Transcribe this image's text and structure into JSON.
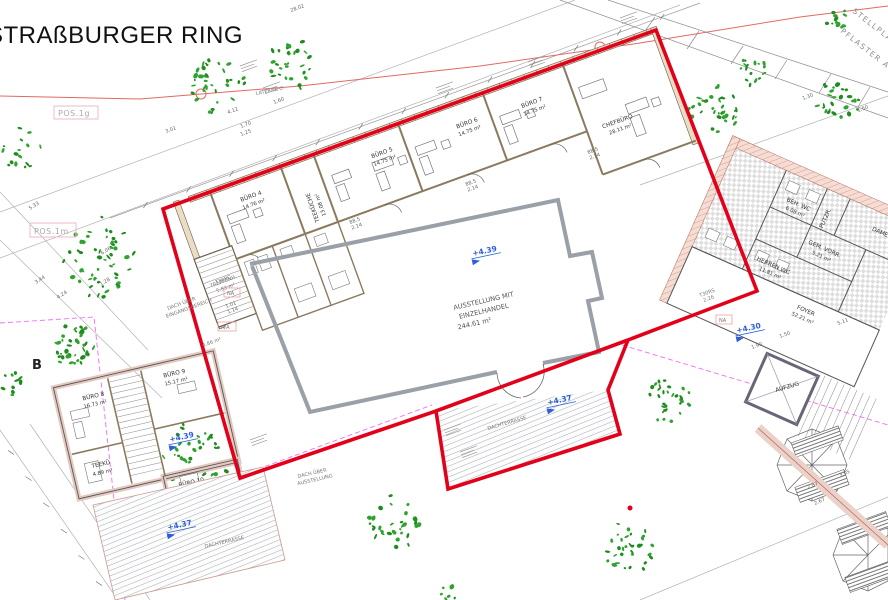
{
  "title": "STRAßBURGER RING",
  "street": {
    "lantern": "LATERNE ∅",
    "parking_line1": "STELLPLÄTZE",
    "parking_line2": "PFLASTER AUSF."
  },
  "tags": {
    "pos1g": "POS.1g",
    "pos1m": "POS.1m",
    "section": "B",
    "na": "NA",
    "aa": "A/A",
    "door1": "T30RS",
    "door1_dim": "2.26",
    "door2": "T30RC",
    "small_room_area": "4.86 m²"
  },
  "levels": {
    "hall": "+4.39",
    "terrace": "+4.37",
    "foyer": "+4.30",
    "annex": "+4.39",
    "annex_terrace": "+4.37"
  },
  "main_building": {
    "hall": {
      "line1": "AUSSTELLUNG MIT",
      "line2": "EINZELHANDEL",
      "area": "244.61 m²"
    },
    "stair": {
      "name": "TREPPENH.",
      "area": "5.83 m²"
    },
    "roof_note": {
      "line1": "DACH ÜBER",
      "line2": "EINGANGSBEREICH"
    },
    "roof_note2": {
      "line1": "DACH ÜBER",
      "line2": "AUSSTELLUNG"
    },
    "terrace": "DACHTERRASSE",
    "rooms": [
      {
        "name": "BÜRO 4",
        "area": "14.76 m²"
      },
      {
        "name": "TEEKÜCHE",
        "area": "13.08 m²"
      },
      {
        "name": "BÜRO 5",
        "area": "14.75 m²"
      },
      {
        "name": "BÜRO 6",
        "area": "14.75 m²"
      },
      {
        "name": "BÜRO 7",
        "area": "14.75 m²"
      },
      {
        "name": "CHEFBÜRO",
        "area": "28.11 m²"
      }
    ]
  },
  "annex": {
    "terrace": "DACHTERRASSE",
    "rooms": [
      {
        "name": "BÜRO 8",
        "area": "16.73 m²"
      },
      {
        "name": "BÜRO 9",
        "area": "15.17 m²"
      },
      {
        "name": "TEEKÜ",
        "area": "4.89 m²"
      },
      {
        "name": "BÜRO 10",
        "area": "16.09 m²"
      }
    ]
  },
  "east_wing": {
    "foyer": {
      "name": "FOYER",
      "area": "52.21 m²"
    },
    "elevator": "AUFZUG",
    "rooms": [
      {
        "name": "BEH. WC",
        "area": "6.08 m²"
      },
      {
        "name": "PUTZR."
      },
      {
        "name": "DAMEN"
      },
      {
        "name": "GEM. VORR.",
        "area": "5.21 m²"
      },
      {
        "name": "HERREN WC",
        "area": "11.81 m²"
      }
    ]
  },
  "dimensions": {
    "d1": "28.02",
    "d2": "3.01",
    "d3": "4.12",
    "d4": "1.70",
    "d5": "1.25",
    "d6": "1.60",
    "d7": "5.33",
    "d8": "6.06",
    "d9": "3.44",
    "d10": "4.24",
    "d11": "1.28",
    "d12": "1.90",
    "d13": "1.50",
    "d14": "5.11",
    "d15": "2.87",
    "d16": "3.05",
    "d17": "2.67",
    "d18": "1.30",
    "d19": "1.50",
    "d20": "2.14",
    "d21": "88.5",
    "d22": "1.01",
    "d23": "1.14"
  },
  "colors": {
    "outline_red": "#e2001a",
    "street_red": "#e06a62",
    "level_blue": "#2b5fd9",
    "vegetation_green": "#2fa32f",
    "magenta_dashed": "#f06ef0",
    "wall_rose": "#f3d7ce",
    "gray_line": "#9aa0a8"
  }
}
